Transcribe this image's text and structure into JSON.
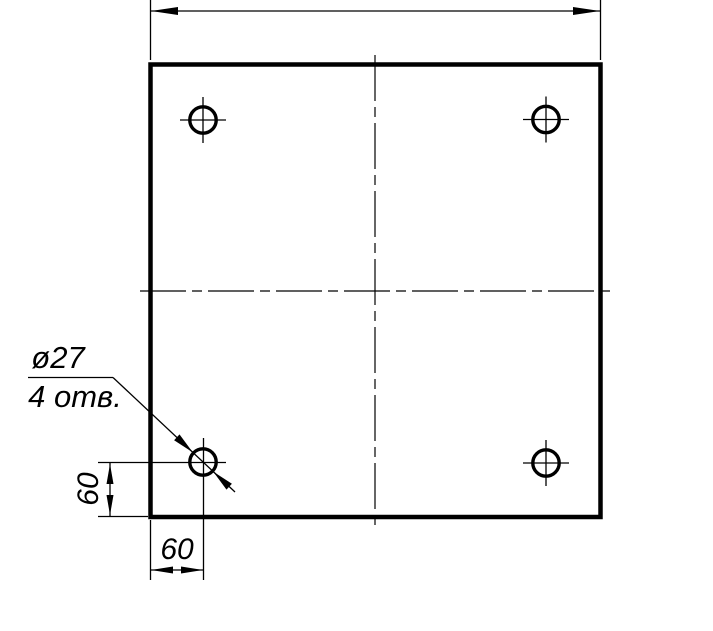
{
  "drawing": {
    "kind": "engineering-drawing-plate-with-holes",
    "background_color": "#ffffff",
    "line_color": "#000000",
    "callout": {
      "diameter_label": "ø27",
      "count_label": "4 отв."
    },
    "dimensions": {
      "left_offset": "60",
      "bottom_offset": "60"
    },
    "part_facts": {
      "hole_count": 4,
      "hole_diameter_mm": 27,
      "hole_edge_offset_x_mm": 60,
      "hole_edge_offset_y_mm": 60
    }
  }
}
